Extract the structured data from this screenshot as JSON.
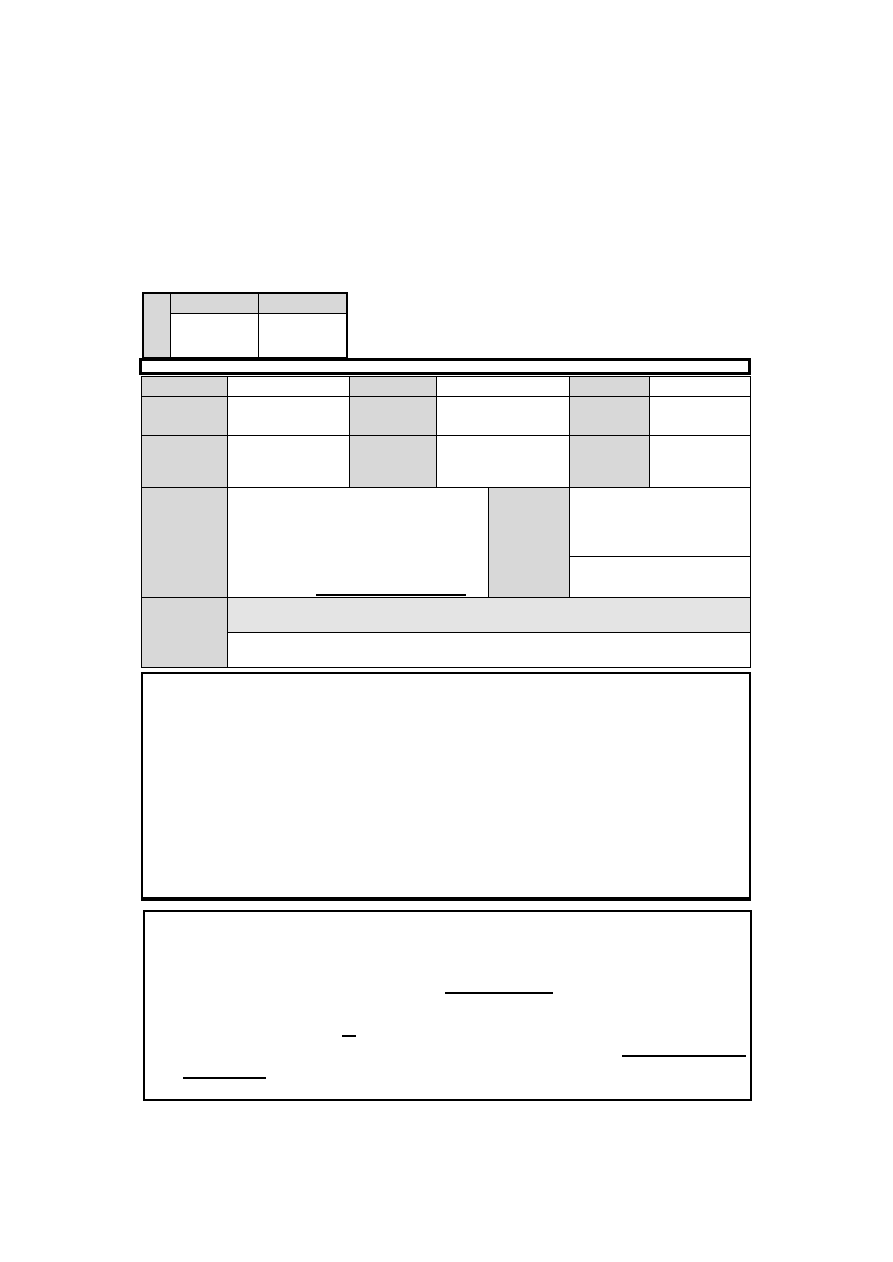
{
  "colors": {
    "page_background": "#ffffff",
    "line_color": "#000000",
    "cell_shading": "#d8d8d8",
    "light_band_shading": "#e4e4e4"
  },
  "header_key_table": {
    "rows": 2,
    "columns": 3,
    "corner_label": "",
    "column_headers": [
      "",
      ""
    ],
    "values": [
      "",
      ""
    ]
  },
  "title_bar": {
    "text": ""
  },
  "detail_table": {
    "rows": 5,
    "columns": 6,
    "label_cells": [
      "",
      "",
      "",
      "",
      "",
      "",
      "",
      "",
      "",
      "",
      ""
    ],
    "value_cells": [
      "",
      "",
      "",
      "",
      "",
      "",
      "",
      "",
      "",
      "",
      ""
    ],
    "row4_blank_line": "",
    "row5_band_blank_line": ""
  },
  "remarks_box": {
    "text": ""
  },
  "signature_box": {
    "text": "",
    "blank_line_count": 4,
    "blank_lines": [
      "",
      "",
      "",
      ""
    ]
  }
}
